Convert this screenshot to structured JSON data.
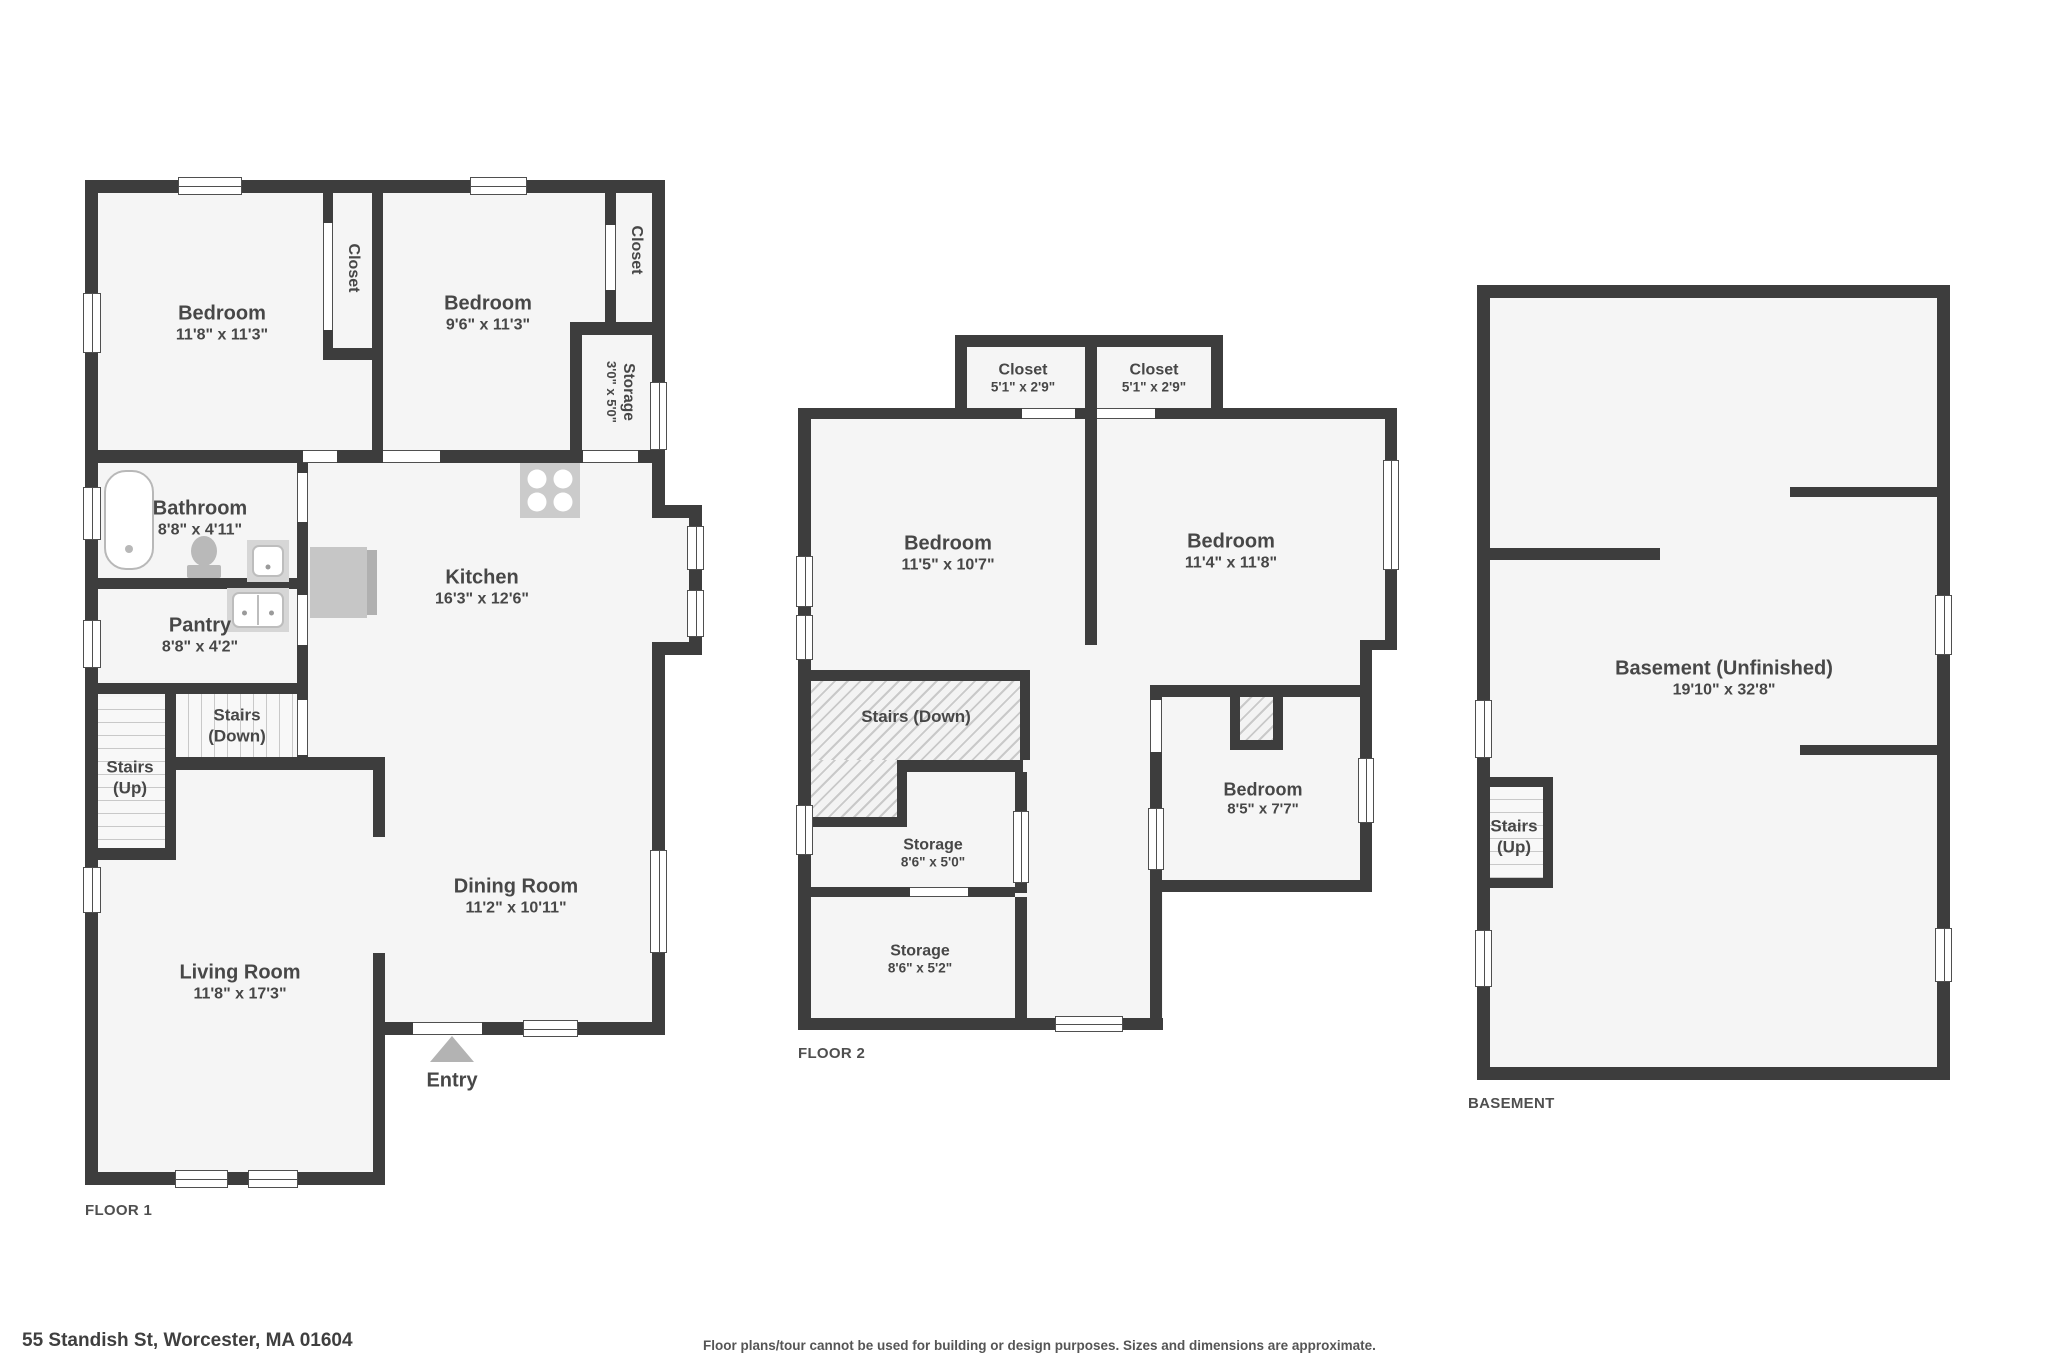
{
  "page": {
    "address": "55 Standish St, Worcester, MA 01604",
    "disclaimer": "Floor plans/tour cannot be used for building or design purposes. Sizes and dimensions are approximate."
  },
  "colors": {
    "wall": "#3d3d3d",
    "room_fill": "#f5f5f5",
    "stairs_fill": "#f8f8f8",
    "hatch_fill": "#f3f3f3",
    "hatch_line": "#c9c9c9",
    "window_frame": "#4f4f4f",
    "fixture": "#c6c6c6",
    "fixture_dark": "#b0b0b0",
    "fixture_light": "#d6d6d6",
    "entry_arrow": "#b3b3b3",
    "label_text": "#474747",
    "floor_label_text": "#4f4f4f"
  },
  "floors": [
    {
      "id": "floor1",
      "label": "FLOOR 1",
      "rooms": [
        {
          "id": "bedroom1",
          "lines": [
            "Bedroom",
            "11'8\" x 11'3\""
          ]
        },
        {
          "id": "closet1",
          "lines": [
            "Closet"
          ]
        },
        {
          "id": "bedroom2",
          "lines": [
            "Bedroom",
            "9'6\" x 11'3\""
          ]
        },
        {
          "id": "closet2",
          "lines": [
            "Closet"
          ]
        },
        {
          "id": "storage_f1",
          "lines": [
            "Storage",
            "3'0\" x 5'0\""
          ]
        },
        {
          "id": "bathroom",
          "lines": [
            "Bathroom",
            "8'8\" x 4'11\""
          ]
        },
        {
          "id": "pantry",
          "lines": [
            "Pantry",
            "8'8\" x 4'2\""
          ]
        },
        {
          "id": "kitchen",
          "lines": [
            "Kitchen",
            "16'3\" x 12'6\""
          ]
        },
        {
          "id": "stairs_down_f1",
          "lines": [
            "Stairs",
            "(Down)"
          ]
        },
        {
          "id": "stairs_up_f1",
          "lines": [
            "Stairs",
            "(Up)"
          ]
        },
        {
          "id": "dining",
          "lines": [
            "Dining Room",
            "11'2\" x 10'11\""
          ]
        },
        {
          "id": "living",
          "lines": [
            "Living Room",
            "11'8\" x 17'3\""
          ]
        },
        {
          "id": "entry",
          "lines": [
            "Entry"
          ]
        }
      ]
    },
    {
      "id": "floor2",
      "label": "FLOOR 2",
      "rooms": [
        {
          "id": "closet_a",
          "lines": [
            "Closet",
            "5'1\" x 2'9\""
          ]
        },
        {
          "id": "closet_b",
          "lines": [
            "Closet",
            "5'1\" x 2'9\""
          ]
        },
        {
          "id": "bedroom_l",
          "lines": [
            "Bedroom",
            "11'5\" x 10'7\""
          ]
        },
        {
          "id": "bedroom_r",
          "lines": [
            "Bedroom",
            "11'4\" x 11'8\""
          ]
        },
        {
          "id": "stairs_down_f2",
          "lines": [
            "Stairs (Down)"
          ]
        },
        {
          "id": "storage1_f2",
          "lines": [
            "Storage",
            "8'6\" x 5'0\""
          ]
        },
        {
          "id": "storage2_f2",
          "lines": [
            "Storage",
            "8'6\" x 5'2\""
          ]
        },
        {
          "id": "bedroom_small",
          "lines": [
            "Bedroom",
            "8'5\" x 7'7\""
          ]
        }
      ]
    },
    {
      "id": "basement",
      "label": "BASEMENT",
      "rooms": [
        {
          "id": "basement_room",
          "lines": [
            "Basement (Unfinished)",
            "19'10\" x 32'8\""
          ]
        },
        {
          "id": "stairs_up_b",
          "lines": [
            "Stairs",
            "(Up)"
          ]
        }
      ]
    }
  ]
}
